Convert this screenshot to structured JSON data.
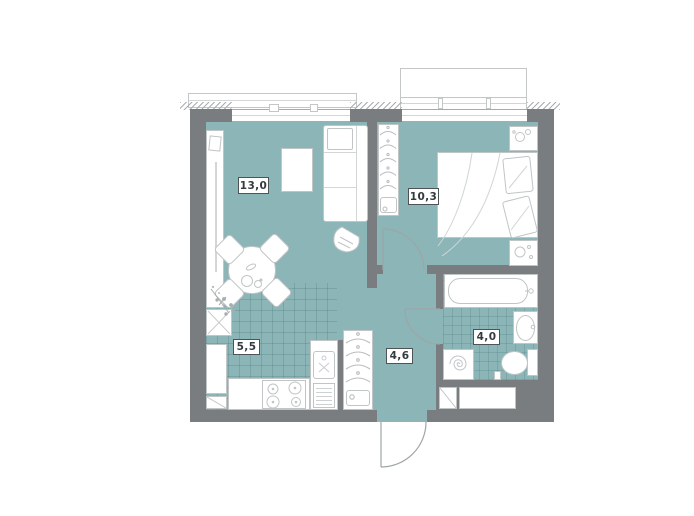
{
  "plan_title": "apartment-floor-plan",
  "rooms": {
    "living": {
      "area_label": "13,0"
    },
    "bedroom": {
      "area_label": "10,3"
    },
    "kitchen": {
      "area_label": "5,5"
    },
    "hallway": {
      "area_label": "4,6"
    },
    "bathroom": {
      "area_label": "4,0"
    }
  },
  "colors": {
    "floor_teal": "#8bb5b7",
    "wall_gray": "#7a7d80",
    "furniture_outline": "#c0c5c6",
    "label_border": "#4e5357",
    "label_text": "#343a3f",
    "background": "#ffffff"
  },
  "furniture_icons": [
    "sofa",
    "coffee-table",
    "tv-unit",
    "plant-icon",
    "guitar-icon",
    "dining-table",
    "dining-chair",
    "hob-unit",
    "refrigerator",
    "corner-cabinet",
    "stove",
    "burner-icon",
    "kitchen-sink",
    "drainboard",
    "wardrobe",
    "hanger-icon",
    "closet",
    "bed",
    "pillow",
    "blanket-fold-icon",
    "nightstand",
    "bathtub",
    "faucet-icon",
    "washbasin",
    "toilet",
    "washing-machine",
    "spiral-icon",
    "entrance-door",
    "bedroom-door",
    "bathroom-door",
    "balcony",
    "window",
    "vent-shaft"
  ]
}
